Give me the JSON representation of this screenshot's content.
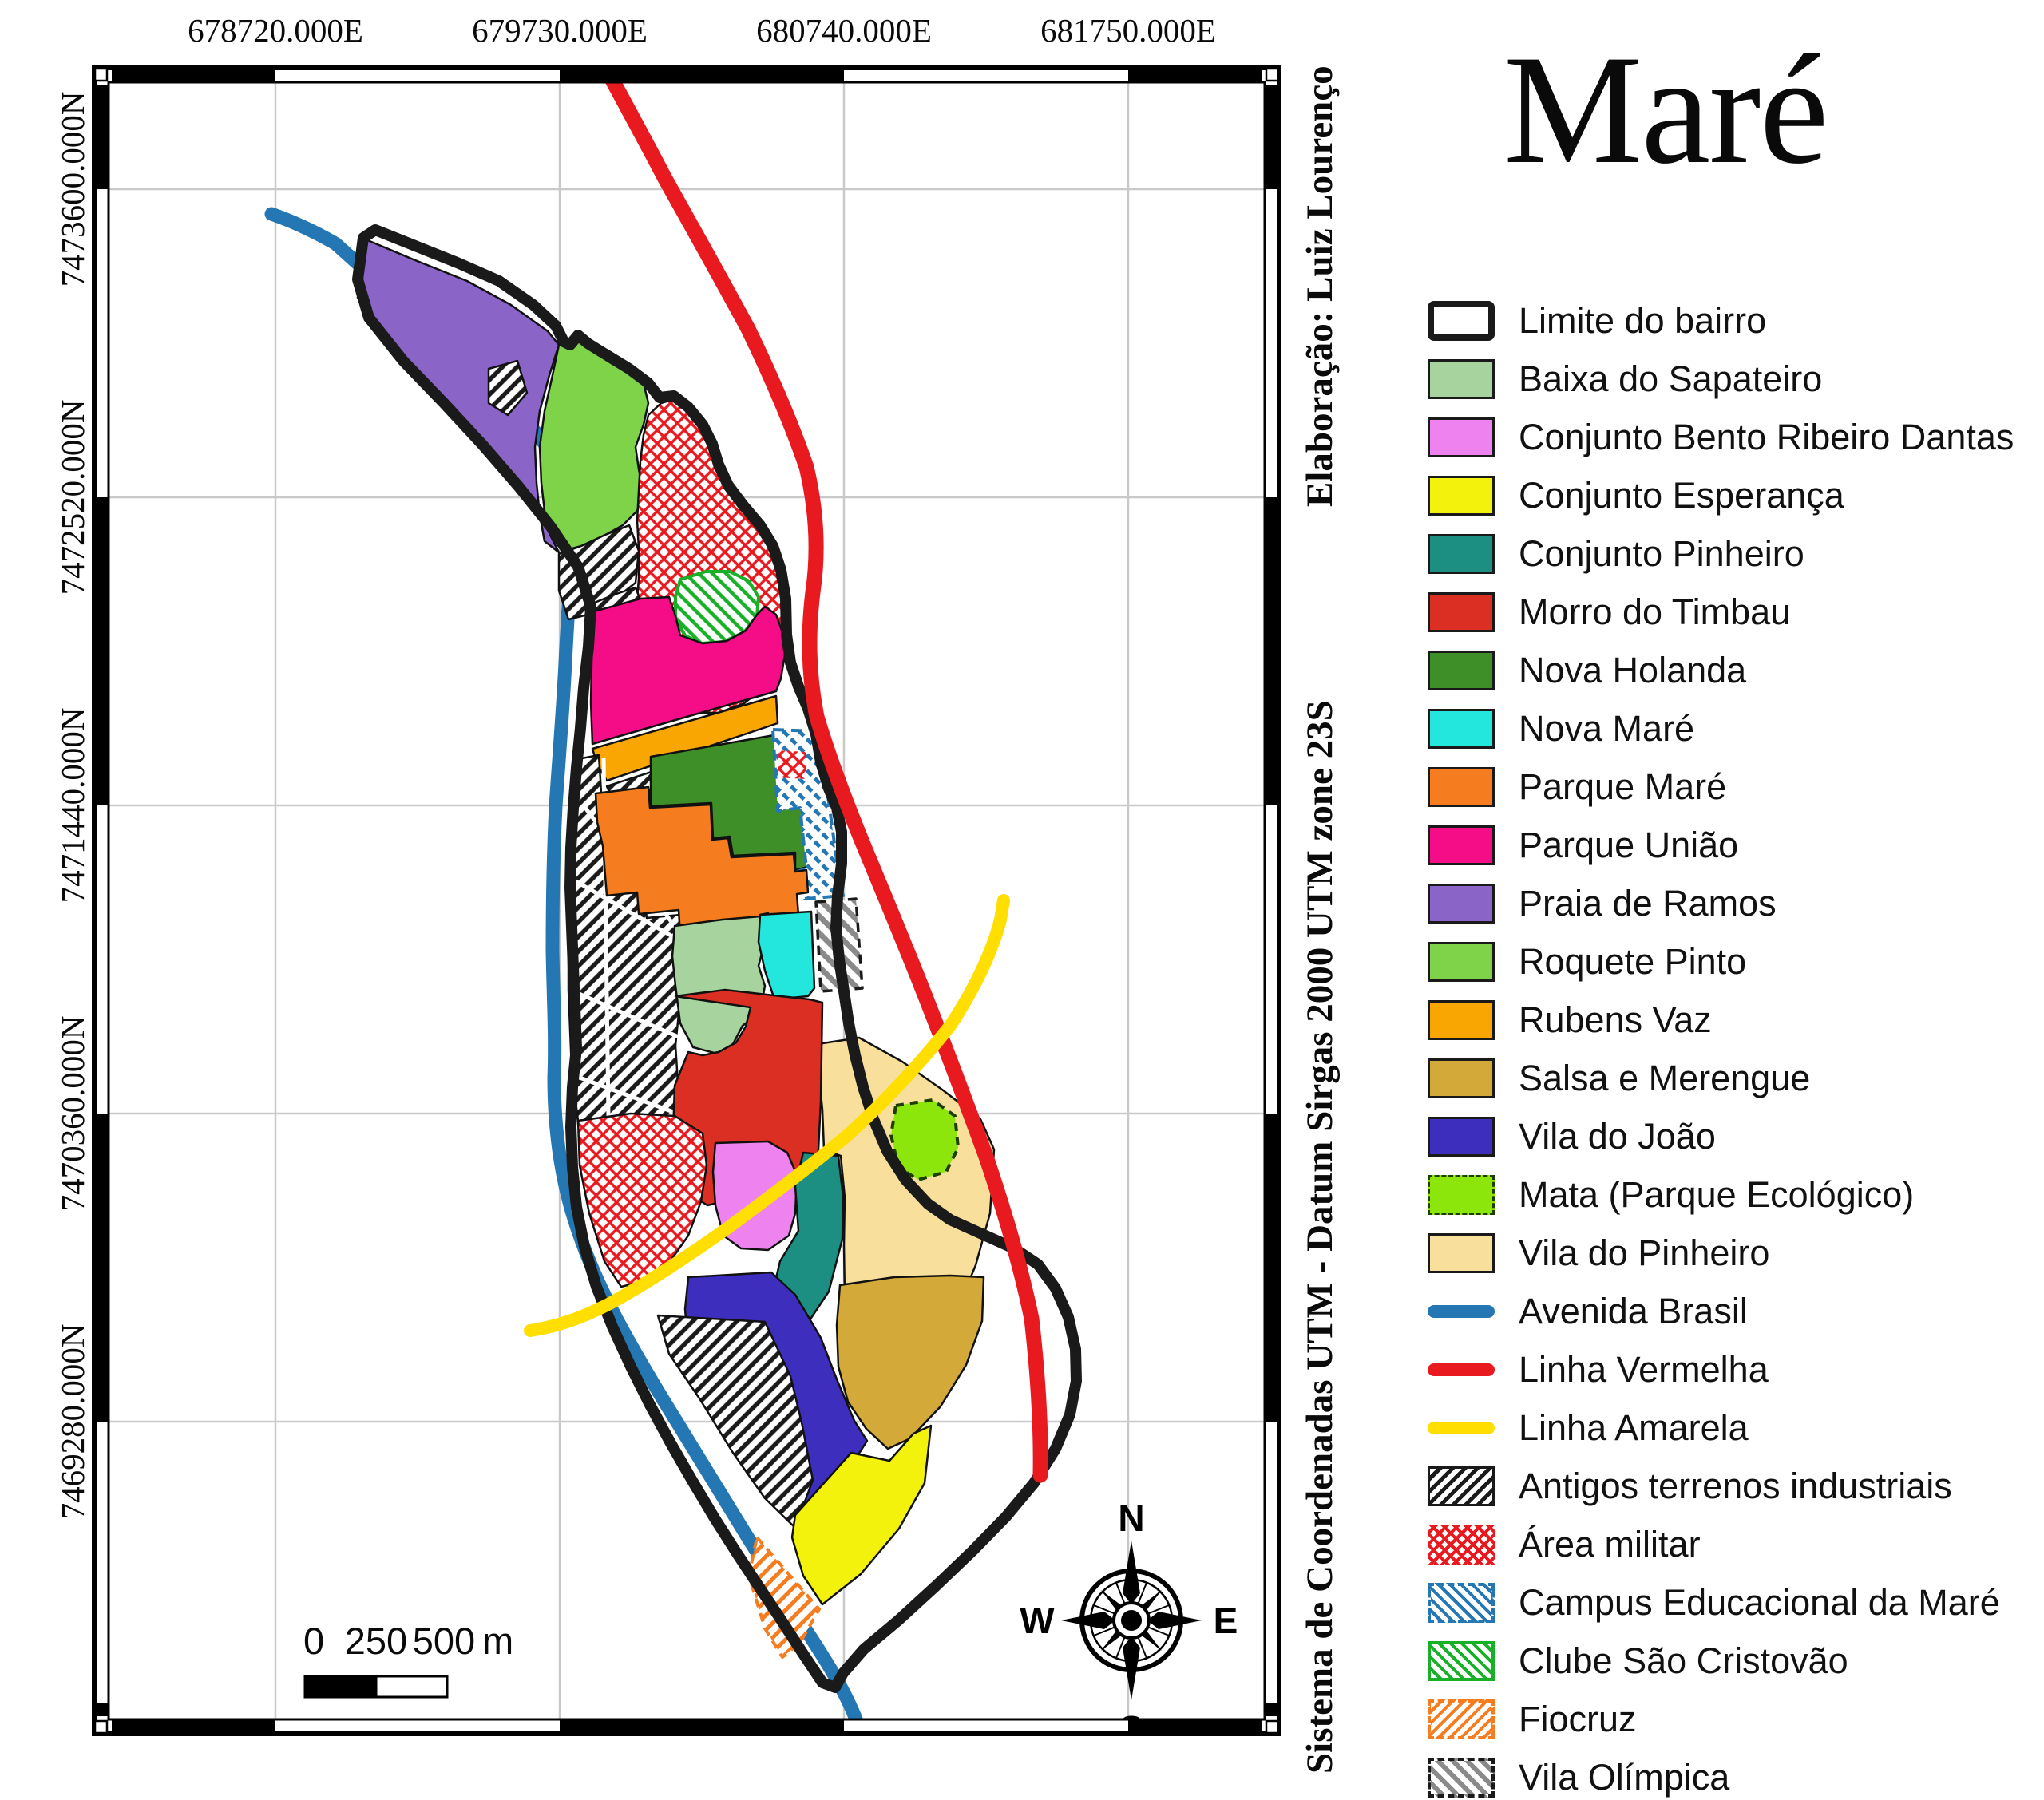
{
  "title": "Maré",
  "credits_right_top": "Elaboração: Luiz Lourenço",
  "credits_right_bottom": "Sistema de Coordenadas UTM - Datum Sirgas 2000 UTM zone 23S",
  "axes": {
    "top": [
      "678720.000E",
      "679730.000E",
      "680740.000E",
      "681750.000E"
    ],
    "left": [
      "7473600.000N",
      "7472520.000N",
      "7471440.000N",
      "7470360.000N",
      "7469280.000N"
    ]
  },
  "scalebar": {
    "start": "0",
    "mid": "250",
    "end": "500",
    "unit": "m"
  },
  "compass": {
    "n": "N",
    "e": "E",
    "s": "S",
    "w": "W"
  },
  "palette": {
    "boundary": "#1A1A1A",
    "baixa_do_sapateiro": "#A6D39E",
    "bento_ribeiro_dantas": "#EE82EE",
    "conjunto_esperanca": "#F2F20C",
    "conjunto_pinheiro": "#1D8F82",
    "morro_do_timbau": "#DC2F23",
    "nova_holanda": "#3F8F29",
    "nova_mare": "#23E6DC",
    "parque_mare": "#F57C1F",
    "parque_uniao": "#F50C87",
    "praia_de_ramos": "#8B64C8",
    "roquete_pinto": "#7ED348",
    "rubens_vaz": "#F9A602",
    "salsa_e_merengue": "#D3A939",
    "vila_do_joao": "#3D2EBE",
    "mata": "#8CE60C",
    "vila_do_pinheiro": "#F8DF9B",
    "avenida_brasil": "#2477B2",
    "linha_vermelha": "#E8191F",
    "linha_amarela": "#FFDE00",
    "hatch_industrial": "#1A1A1A",
    "hatch_militar": "#E8191F",
    "hatch_campus": "#2477B2",
    "hatch_clube": "#17B026",
    "hatch_fiocruz": "#F57C1F",
    "hatch_olimpica": "#8A8A8A",
    "grid": "#C9C9C9",
    "frame": "#000000"
  },
  "legend": {
    "items": [
      {
        "label": "Limite do bairro",
        "type": "outline",
        "color": "#1A1A1A"
      },
      {
        "label": "Baixa do Sapateiro",
        "type": "fill",
        "color": "#A6D39E"
      },
      {
        "label": "Conjunto Bento Ribeiro Dantas",
        "type": "fill",
        "color": "#EE82EE"
      },
      {
        "label": "Conjunto Esperança",
        "type": "fill",
        "color": "#F2F20C"
      },
      {
        "label": "Conjunto Pinheiro",
        "type": "fill",
        "color": "#1D8F82"
      },
      {
        "label": "Morro do Timbau",
        "type": "fill",
        "color": "#DC2F23"
      },
      {
        "label": "Nova Holanda",
        "type": "fill",
        "color": "#3F8F29"
      },
      {
        "label": "Nova Maré",
        "type": "fill",
        "color": "#23E6DC"
      },
      {
        "label": "Parque Maré",
        "type": "fill",
        "color": "#F57C1F"
      },
      {
        "label": "Parque União",
        "type": "fill",
        "color": "#F50C87"
      },
      {
        "label": "Praia de Ramos",
        "type": "fill",
        "color": "#8B64C8"
      },
      {
        "label": "Roquete Pinto",
        "type": "fill",
        "color": "#7ED348"
      },
      {
        "label": "Rubens Vaz",
        "type": "fill",
        "color": "#F9A602"
      },
      {
        "label": "Salsa e Merengue",
        "type": "fill",
        "color": "#D3A939"
      },
      {
        "label": "Vila do João",
        "type": "fill",
        "color": "#3D2EBE"
      },
      {
        "label": "Mata (Parque Ecológico)",
        "type": "fill-dashed",
        "color": "#8CE60C"
      },
      {
        "label": "Vila do Pinheiro",
        "type": "fill",
        "color": "#F8DF9B"
      },
      {
        "label": "Avenida Brasil",
        "type": "line",
        "color": "#2477B2"
      },
      {
        "label": "Linha Vermelha",
        "type": "line",
        "color": "#E8191F"
      },
      {
        "label": "Linha Amarela",
        "type": "line",
        "color": "#FFDE00"
      },
      {
        "label": "Antigos terrenos industriais",
        "type": "hatch-diag",
        "color": "#1A1A1A"
      },
      {
        "label": "Área militar",
        "type": "hatch-cross",
        "color": "#E8191F"
      },
      {
        "label": "Campus Educacional da Maré",
        "type": "hatch-back-dashed",
        "color": "#2477B2"
      },
      {
        "label": "Clube São Cristovão",
        "type": "hatch-back-solid",
        "color": "#17B026"
      },
      {
        "label": "Fiocruz",
        "type": "hatch-diag-dashed",
        "color": "#F57C1F"
      },
      {
        "label": "Vila Olímpica",
        "type": "hatch-back-dashed-black",
        "color": "#8A8A8A"
      }
    ]
  }
}
